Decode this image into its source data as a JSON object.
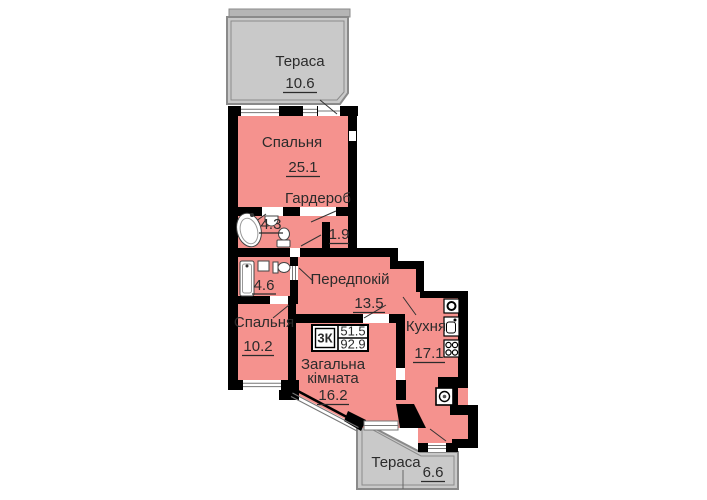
{
  "plan": {
    "terrace_top": {
      "label": "Тераса",
      "area": "10.6"
    },
    "bedroom1": {
      "label": "Спальня",
      "area": "25.1"
    },
    "wardrobe": {
      "label": "Гардероб",
      "area": "1.9"
    },
    "bathroom1": {
      "area": "4.3"
    },
    "bathroom2": {
      "area": "4.6"
    },
    "hallway": {
      "label": "Передпокій",
      "area": "13.5"
    },
    "bedroom2": {
      "label": "Спальня",
      "area": "10.2"
    },
    "living_room": {
      "label_line1": "Загальна",
      "label_line2": "кімната",
      "area": "16.2"
    },
    "kitchen": {
      "label": "Кухня",
      "area": "17.1"
    },
    "terrace_bottom": {
      "label": "Тераса",
      "area": "6.6"
    },
    "summary_box": {
      "type": "3К",
      "living_area": "51.5",
      "total_area": "92.9"
    }
  },
  "colors": {
    "wall": "#000000",
    "room": "#f5928e",
    "terrace": "#c9c9c9",
    "rail": "#b5b5b5",
    "outline": "#8a8a8a"
  }
}
